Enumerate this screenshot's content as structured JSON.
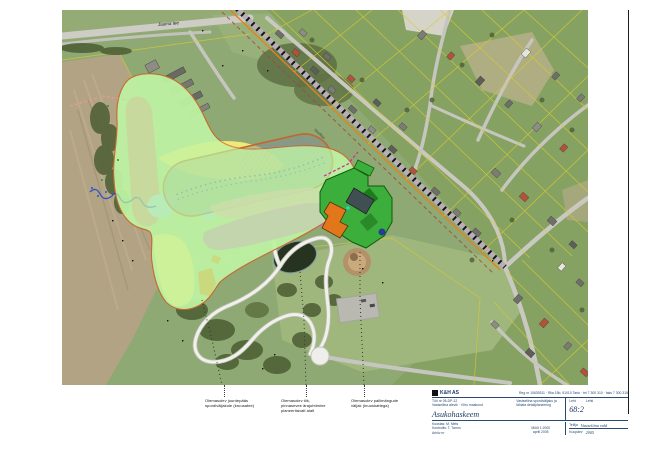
{
  "page": {
    "background": "#ffffff",
    "border_color": "#1c1c1c"
  },
  "map": {
    "street_label": "Jaama tee",
    "railway_label": "raudtee",
    "zone_colors": {
      "planning_area_green": "#bdf2a2",
      "sports_yellow": "#fcee7d",
      "existing_track_salmon": "#e59191",
      "stadium_fill_gray": "#7d8a94",
      "stadium_outline_orange": "#c2672f",
      "water_light_blue": "#aadcf2",
      "band_pink": "#f3a9c3",
      "band_magenta": "#e06ae0",
      "patch_orange": "#f0951f",
      "planned_area_green": "#3cae3c",
      "planned_building_orange": "#e2761b",
      "cadastral_yellow": "#d8ca2f"
    }
  },
  "annotations": {
    "block1": {
      "line1": "Olemasolev juurdepääs",
      "line2": "spordiväljakule (kruusatee)"
    },
    "block2": {
      "line1": "Olemasolev tiik,",
      "line2": "pinnasevee ärajuhtimine",
      "line3": "planeeritavalt alalt"
    },
    "block3": {
      "line1": "Olemasolev pallimängude",
      "line2": "väljak (kruuskattega)"
    }
  },
  "title_block": {
    "company": "K&H AS",
    "contact": "Reg nr 10639311 · Riia 15b, 51010 Tartu · tel 7 300 310 · faks 7 300 315",
    "project_line1": "Töö nr 05-DP-12",
    "project_line2": "Vastseliina alevik · Võru maakond",
    "sheet_title": "Asukohaskeem",
    "mid_line1": "Vastseliina spordiväljaku ja",
    "mid_line2": "lähiala detailplaneering",
    "sheet_label": "Leht",
    "sheet_count_label": "Lehti",
    "sheet_no": "68:2",
    "bottom_line1": "Koostas: M. Mets",
    "bottom_line2": "Kontrollis: T. Tamm",
    "bottom_line3": "Arhiiv nr",
    "center_line1": "Mõõt 1:2000",
    "center_line2": "aprill 2005",
    "right_row1_label": "Tellija",
    "right_row1_value": "Vastseliina vald",
    "right_row2_label": "Kuupäev",
    "right_row2_value": "2005"
  }
}
